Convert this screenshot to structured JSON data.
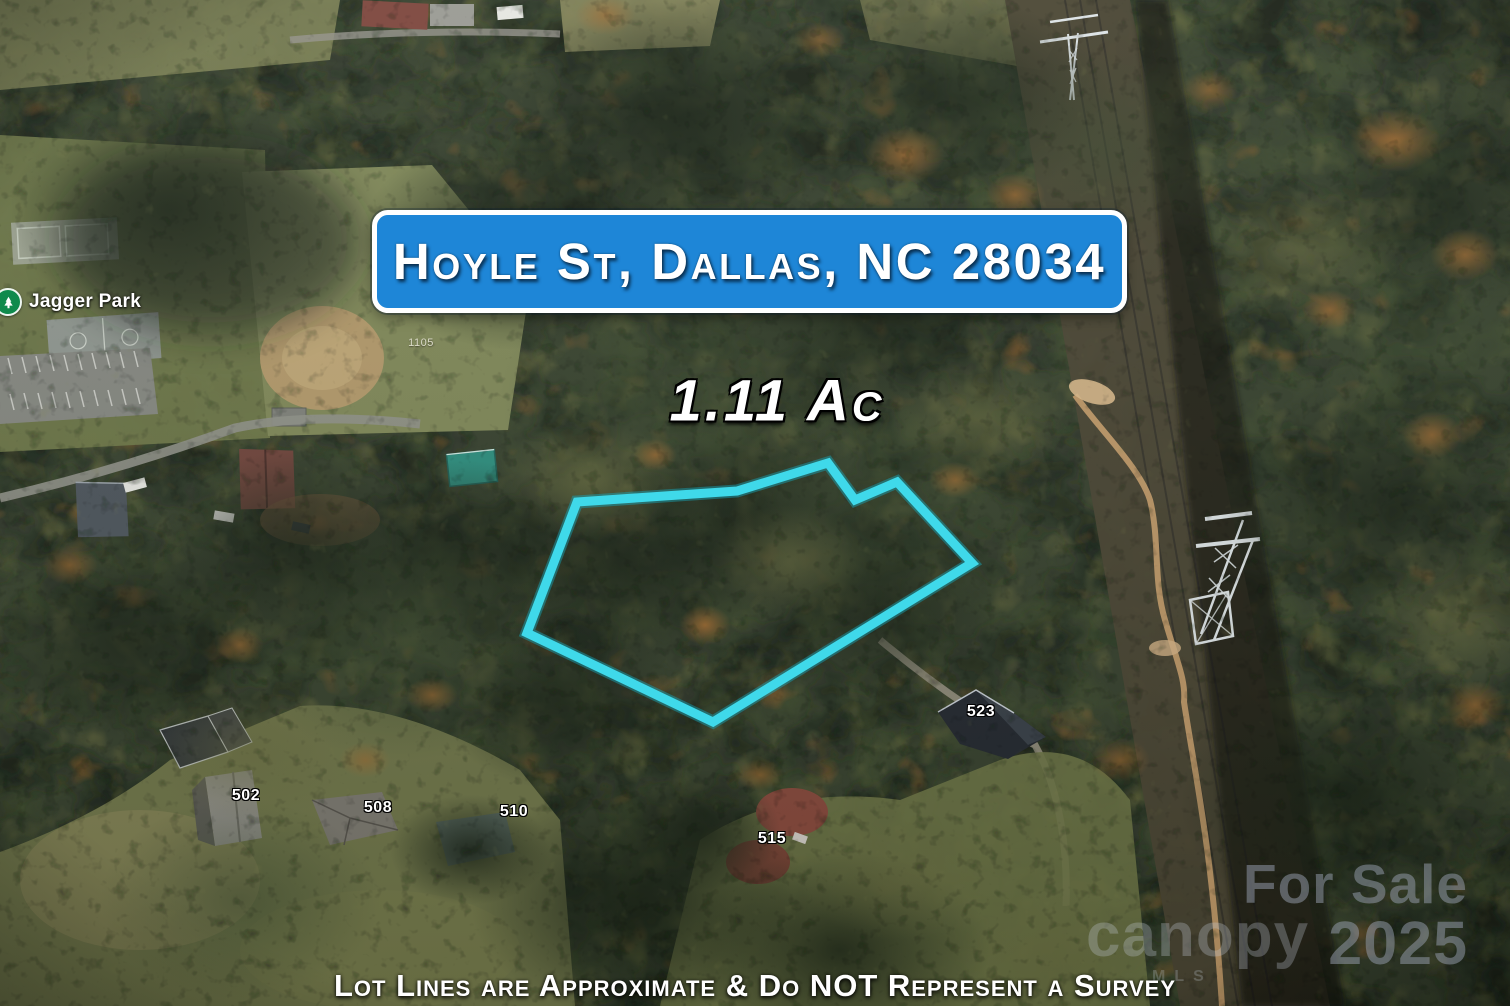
{
  "banner": {
    "title": "Hoyle St, Dallas, NC 28034"
  },
  "lot": {
    "acreage_label": "1.11 Ac",
    "outline_color": "#3fd9ea",
    "polygon_points": "577,502 737,491 828,463 855,500 897,482 972,563 713,722 527,633"
  },
  "map_labels": {
    "park_name": "Jagger Park",
    "house_numbers": [
      {
        "label": "1105"
      },
      {
        "label": "502"
      },
      {
        "label": "508"
      },
      {
        "label": "510"
      },
      {
        "label": "515"
      },
      {
        "label": "523"
      }
    ]
  },
  "disclaimer": {
    "text": "Lot Lines are Approximate & Do NOT Represent a Survey"
  },
  "watermark": {
    "sale_line1": "For Sale",
    "sale_line2": "2025",
    "brand": "canopy",
    "brand_sub": "MLS"
  },
  "colors": {
    "banner_blue": "#1e86d7",
    "lot_outline": "#3fd9ea",
    "park_icon_green": "#0f8a4c"
  }
}
